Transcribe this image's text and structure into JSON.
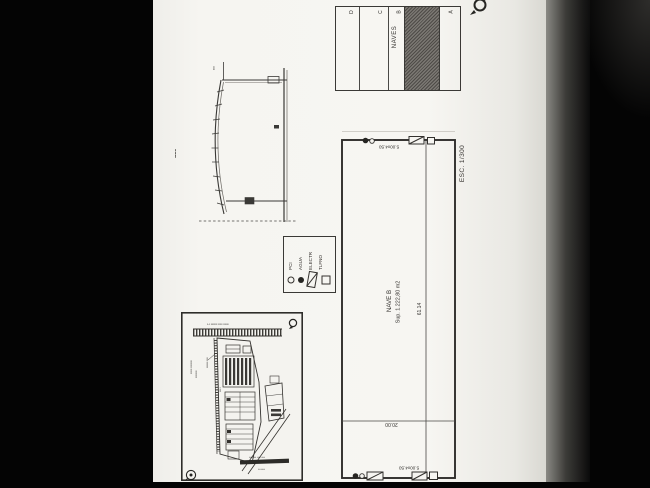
{
  "document": {
    "type_note": "scanned architectural plan sheet, drawing rotated 90",
    "page_bg": "#f6f5f1",
    "ink": "#33312e",
    "hatch_color": "#4e4b47"
  },
  "key_diagram": {
    "title": "NAVES",
    "strips": [
      {
        "label": "D",
        "hatched": false
      },
      {
        "label": "C",
        "hatched": false
      },
      {
        "label": "B",
        "hatched": true
      },
      {
        "label": "A",
        "hatched": false
      }
    ]
  },
  "legend": {
    "items": [
      {
        "label": "PCI",
        "symbol": "open-circle"
      },
      {
        "label": "AGUA",
        "symbol": "filled-circle"
      },
      {
        "label": "ELECTR",
        "symbol": "slashed-rect"
      },
      {
        "label": "TLFNO",
        "symbol": "open-square"
      }
    ]
  },
  "main_plan": {
    "name": "NAVE B",
    "area": "Sup. 1.222,80 m2",
    "dim_length": "61.14",
    "dim_width": "20.00",
    "module_top": "5.00x4.50",
    "module_bottom": "5.00x4.50",
    "scale": "ESC. 1/300"
  },
  "section_drawing": {
    "caption_small": "▪▪▪",
    "side_caption": "▪▪▪▪ ▪▪▪ ▪▪▪"
  },
  "site_plan": {
    "caption_railway": "▪-▪ ▪▪▪▪▪▪ ▪▪▪▪ ▪▪▪▪▪",
    "caption_left_1": "▪▪▪▪▪ ▪▪▪▪▪▪▪",
    "caption_left_2": "▪▪▪▪▪▪▪",
    "caption_leader": "▪▪▪▪▪▪ ▪▪▪▪",
    "caption_mid": "▪▪▪ ▪",
    "caption_road_top": "▪▪▪▪▪▪▪▪ ▪▪▪▪ ▪▪▪▪",
    "caption_road_bottom": "▪▪ ▪▪▪▪▪"
  }
}
